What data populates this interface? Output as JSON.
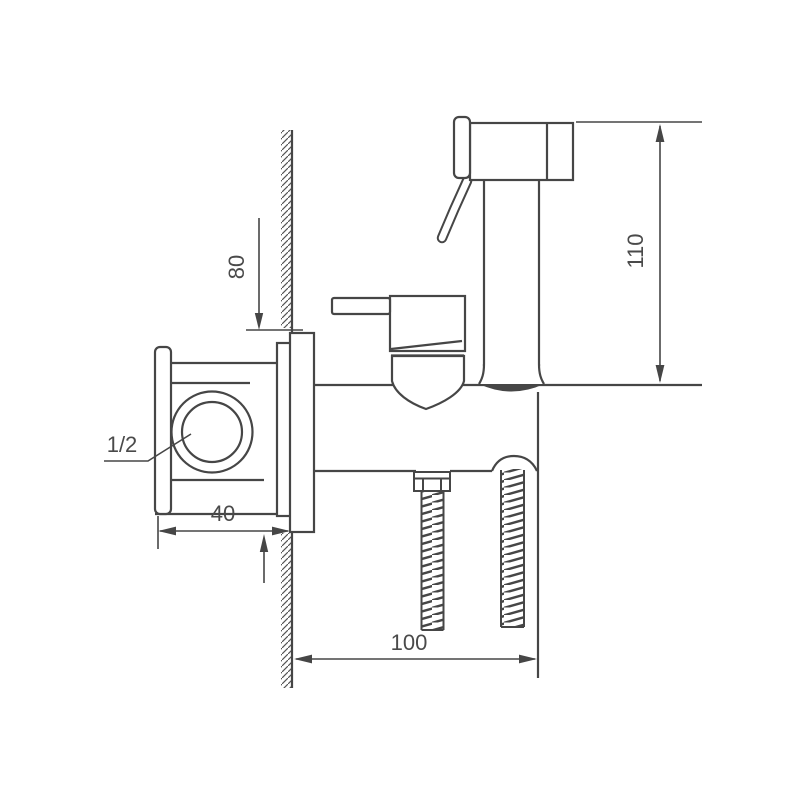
{
  "drawing": {
    "kind": "technical line drawing",
    "subject": "wall-mounted bidet sprayer mixer, side section view",
    "background": "#ffffff",
    "line_color": "#464646",
    "text_color": "#4a4a4a",
    "connection_label": "1/2",
    "dims": {
      "sprayer_height": "110",
      "plate_height": "80",
      "wall_depth": "40",
      "projection": "100"
    }
  }
}
